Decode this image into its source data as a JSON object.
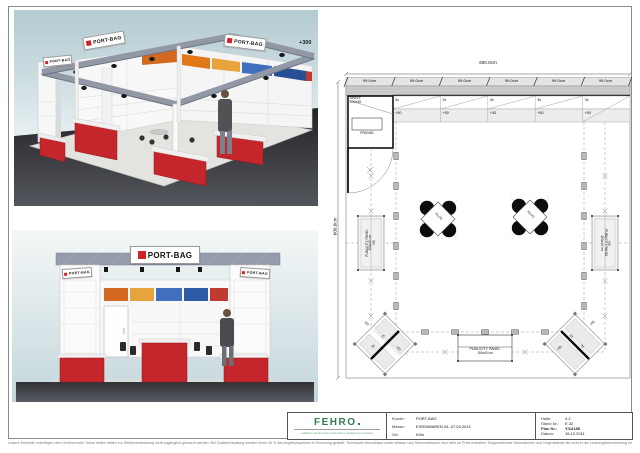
{
  "colors": {
    "brand_red": "#cf2127",
    "logo_green": "#2e7d4f"
  },
  "renders": {
    "brand": "PORT-BAG",
    "height_label": "+300"
  },
  "plan": {
    "dim_total_top": "600.0cm",
    "dim_total_left": "600.0cm",
    "dim_segments": [
      "99.0cm",
      "99.0cm",
      "99.0cm",
      "99.0cm",
      "99.0cm",
      "99.0cm"
    ],
    "shelf_qty": [
      "3x",
      "3x",
      "3x",
      "3x",
      "3x"
    ],
    "shelf_height": [
      "+50",
      "+50",
      "+50",
      "+50",
      "+50"
    ],
    "storage_shelf_line1": "SHELF",
    "storage_shelf_line2": "100x30",
    "fridge": "FRIDGE",
    "table_size": "70x70",
    "panel_line1": "PUBLICITY PANEL",
    "panel_line2": "150x40 cm",
    "panel_plus": "+50",
    "corner_qty_a": "2x",
    "corner_qty_b": "3x",
    "corner_plus": "+50"
  },
  "titleblock": {
    "logo": "FEHRO",
    "tagline": "exhibition service and construction management company",
    "left": [
      {
        "label": "Kunde:",
        "value": "PORT-BAG"
      },
      {
        "label": "Messe:",
        "value": "EISENWAREN 04.-07.03.2012"
      },
      {
        "label": "Ort:",
        "value": "Köln"
      }
    ],
    "right": [
      {
        "label": "Halle:",
        "value": "4.2"
      },
      {
        "label": "Stand Nr.:",
        "value": "E.32"
      },
      {
        "label": "Plan Nr.:",
        "value": "Y/12135"
      },
      {
        "label": "Datum:",
        "value": "15.12.2011"
      }
    ]
  },
  "sheet": {
    "disclaimer": "Unsere Entwürfe unterliegen dem Urheberrecht. Diese dürfen dritten zur Weiterverarbeitung nicht zugänglich gemacht werden. Bei Zuwiderhandlung werden Ihnen 40 % des Angebotspreises in Rechnung gestellt. Technische Anschlüsse sowie Wasser und Stromverbrauch sind nicht im Preis enthalten. Eingezeichnete Dekorationen und Gegenstände die nicht in der Leistungsbeschreibung enthalten sind, gehören nicht zum Lieferumfang. Änderungen durch die Messe bleiben vorbehalten."
  }
}
